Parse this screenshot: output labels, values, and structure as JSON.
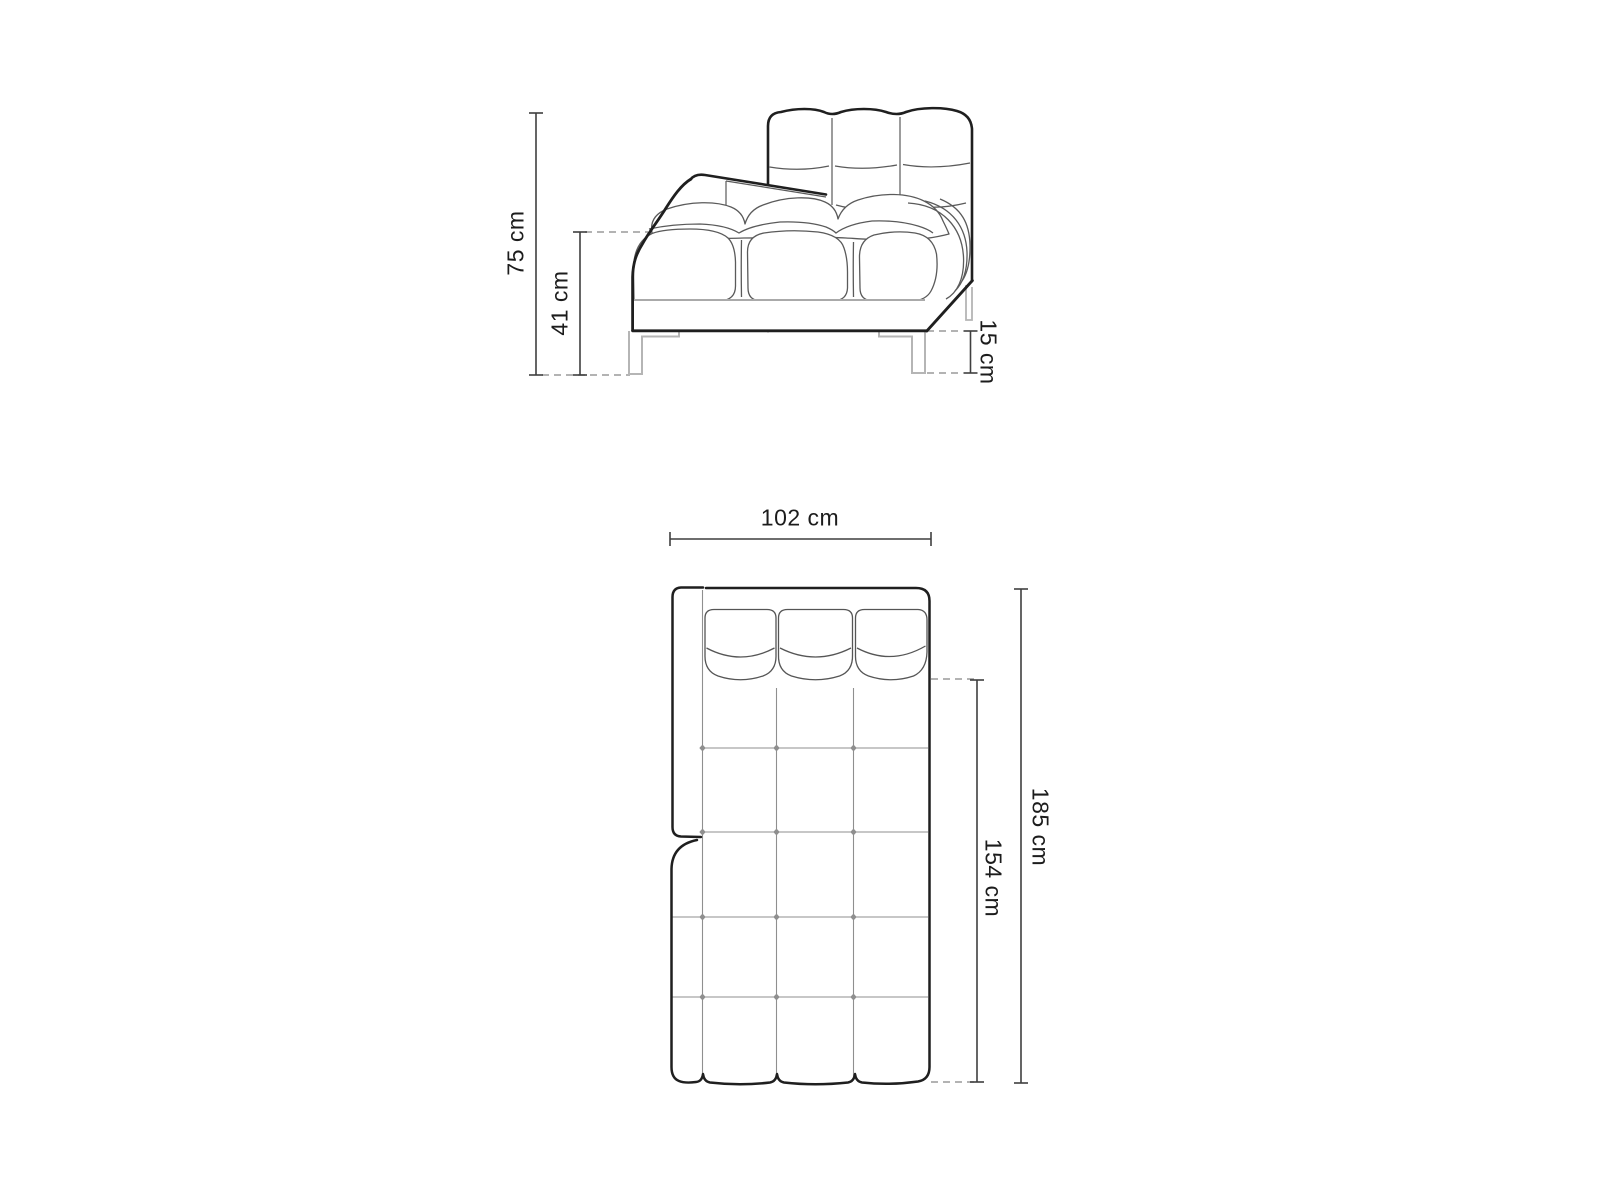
{
  "page": {
    "background_color": "#ffffff",
    "description": "Furniture dimension diagram of a tufted chaise-longue daybed: side elevation (top) and top plan view (bottom)"
  },
  "side_view": {
    "name": "side-elevation",
    "dims": {
      "total_height": "75 cm",
      "seat_height": "41 cm",
      "leg_height": "15 cm"
    }
  },
  "plan_view": {
    "name": "top-plan",
    "dims": {
      "width": "102 cm",
      "seat_depth": "154 cm",
      "total_depth": "185 cm"
    }
  },
  "style": {
    "outline_color": "#1f1f1f",
    "seam_color": "#5a5a5a",
    "grid_color": "#8f8f8f",
    "leg_color": "#b5b5b5",
    "dimension_color": "#3f3f3f",
    "dash_color": "#9a9a9a",
    "text_color": "#1c1c1c"
  }
}
